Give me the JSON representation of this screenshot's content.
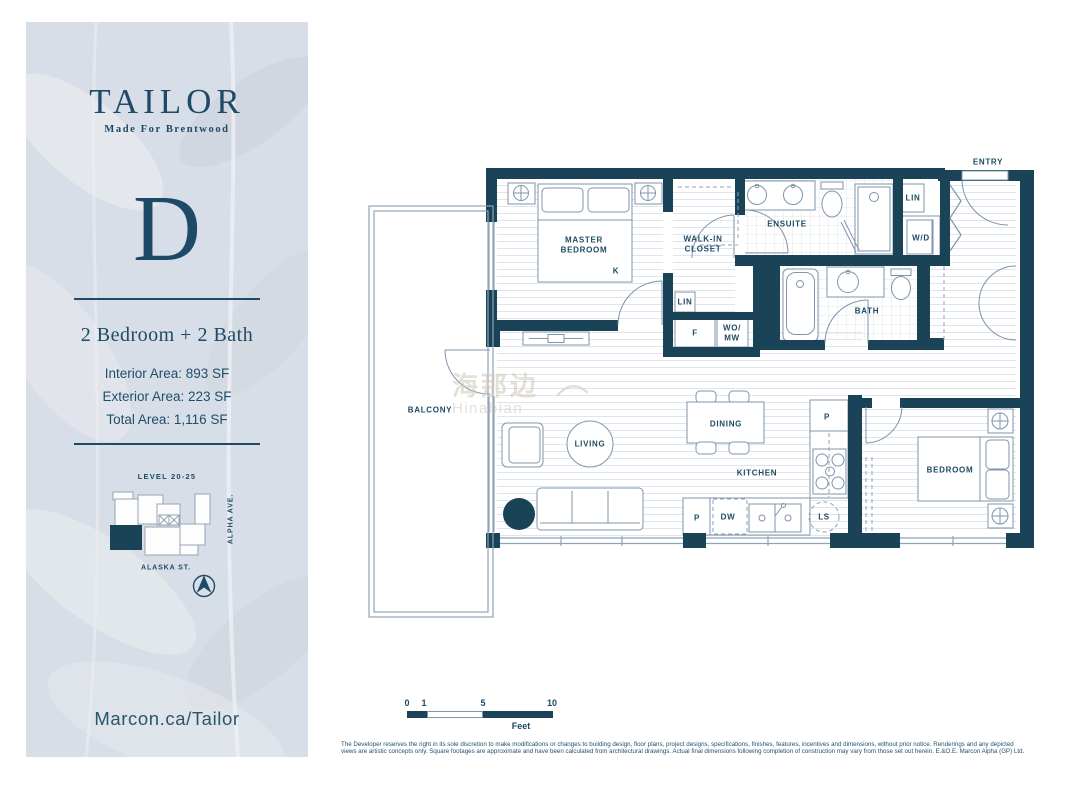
{
  "sidebar": {
    "logo": "TAILOR",
    "tagline": "Made For Brentwood",
    "plan_letter": "D",
    "plan_type": "2 Bedroom + 2 Bath",
    "areas": {
      "interior": "Interior Area: 893 SF",
      "exterior": "Exterior Area: 223 SF",
      "total": "Total Area: 1,116 SF"
    },
    "keyplan": {
      "level": "LEVEL 20-25",
      "street_right": "ALPHA AVE.",
      "street_bottom": "ALASKA ST."
    },
    "website": "Marcon.ca/Tailor"
  },
  "rooms": {
    "master_line1": "MASTER",
    "master_line2": "BEDROOM",
    "bed_type": "K",
    "walkin_line1": "WALK-IN",
    "walkin_line2": "CLOSET",
    "lin_closet": "LIN",
    "fridge": "F",
    "wallovens_line1": "WO/",
    "wallovens_line2": "MW",
    "ensuite": "ENSUITE",
    "lin_entry": "LIN",
    "washer_dryer": "W/D",
    "entry": "ENTRY",
    "bath": "BATH",
    "balcony": "BALCONY",
    "living": "LIVING",
    "dining": "DINING",
    "kitchen": "KITCHEN",
    "pantry_upper": "P",
    "pantry_lower": "P",
    "dishwasher": "DW",
    "lazy_susan": "LS",
    "bedroom": "BEDROOM"
  },
  "scalebar": {
    "tick_0": "0",
    "tick_1": "1",
    "tick_5": "5",
    "tick_10": "10",
    "unit_label": "Feet"
  },
  "watermark": {
    "cn": "海那边",
    "en": "Hinabian"
  },
  "disclaimer": {
    "line1": "The Developer reserves the right in its sole discretion to make modifications or changes to building design, floor plans, project designs, specifications, finishes, features, incentives and dimensions, without prior notice. Renderings and any depicted",
    "line2": "views are artistic concepts only. Square footages are approximate and have been calculated from architectural drawings. Actual final dimensions following completion of construction may vary from those set out herein. E.&O.E. Marcon Alpha (GP) Ltd."
  },
  "colors": {
    "wall": "#1b4357",
    "text": "#1d4a66",
    "sidebar_bg": "#d8dee7",
    "line": "#7f94aa",
    "hatch": "#dfe5ec"
  }
}
